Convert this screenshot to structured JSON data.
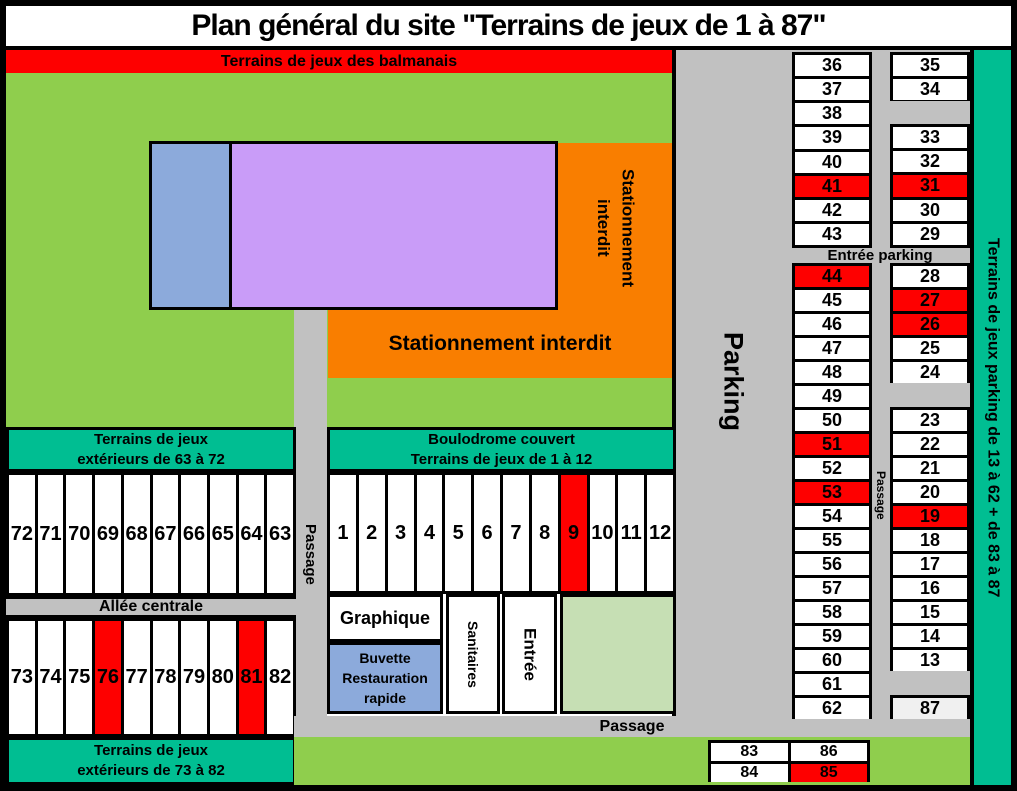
{
  "title": "Plan général du site \"Terrains de jeux de 1 à 87\"",
  "banners": {
    "balmanais": "Terrains de jeux des balmanais",
    "ext6372": [
      "Terrains de jeux",
      "extérieurs de 63 à 72"
    ],
    "boulodrome": [
      "Boulodrome couvert",
      "Terrains de jeux de 1 à 12"
    ],
    "ext7382": [
      "Terrains de jeux",
      "extérieurs de 73 à 82"
    ],
    "teal_right": "Terrains de jeux parking de 13 à 62 + de 83 à 87"
  },
  "labels": {
    "stationnement_vertical": [
      "Stationnement",
      "interdit"
    ],
    "stationnement_horizontal": "Stationnement interdit",
    "parking": "Parking",
    "passage_left": "Passage",
    "passage_right": "Passage",
    "passage_bottom": "Passage",
    "allee_centrale": "Allée centrale",
    "entree_parking": "Entrée parking",
    "graphique": "Graphique",
    "buvette": [
      "Buvette",
      "Restauration",
      "rapide"
    ],
    "sanitaires": "Sanitaires",
    "entree": "Entrée"
  },
  "colors": {
    "green": "#8FCE4D",
    "pale_green": "#C6DFB4",
    "teal": "#00BE92",
    "orange": "#F97E00",
    "red": "#FE0000",
    "gray": "#C1C1C1",
    "blue": "#8CAADB",
    "purple": "#C99CF8",
    "light_cell": "#F0F0F0"
  },
  "courts": {
    "row_63_72": [
      {
        "n": "72"
      },
      {
        "n": "71"
      },
      {
        "n": "70"
      },
      {
        "n": "69"
      },
      {
        "n": "68"
      },
      {
        "n": "67"
      },
      {
        "n": "66"
      },
      {
        "n": "65"
      },
      {
        "n": "64"
      },
      {
        "n": "63"
      }
    ],
    "row_1_12": [
      {
        "n": "1"
      },
      {
        "n": "2"
      },
      {
        "n": "3"
      },
      {
        "n": "4"
      },
      {
        "n": "5"
      },
      {
        "n": "6"
      },
      {
        "n": "7"
      },
      {
        "n": "8"
      },
      {
        "n": "9",
        "bg": "red"
      },
      {
        "n": "10"
      },
      {
        "n": "11"
      },
      {
        "n": "12"
      }
    ],
    "row_73_82": [
      {
        "n": "73"
      },
      {
        "n": "74"
      },
      {
        "n": "75"
      },
      {
        "n": "76",
        "bg": "red"
      },
      {
        "n": "77"
      },
      {
        "n": "78"
      },
      {
        "n": "79"
      },
      {
        "n": "80"
      },
      {
        "n": "81",
        "bg": "red"
      },
      {
        "n": "82"
      }
    ],
    "colA_top": [
      {
        "n": "36"
      },
      {
        "n": "37"
      },
      {
        "n": "38"
      },
      {
        "n": "39"
      },
      {
        "n": "40"
      },
      {
        "n": "41",
        "bg": "red"
      },
      {
        "n": "42"
      },
      {
        "n": "43"
      }
    ],
    "colB_top_a": [
      {
        "n": "35"
      },
      {
        "n": "34"
      }
    ],
    "colB_top_b": [
      {
        "n": "33"
      },
      {
        "n": "32"
      },
      {
        "n": "31",
        "bg": "red"
      },
      {
        "n": "30"
      },
      {
        "n": "29"
      }
    ],
    "colA_bottom": [
      {
        "n": "44",
        "bg": "red"
      },
      {
        "n": "45"
      },
      {
        "n": "46"
      },
      {
        "n": "47"
      },
      {
        "n": "48"
      },
      {
        "n": "49"
      },
      {
        "n": "50"
      },
      {
        "n": "51",
        "bg": "red"
      },
      {
        "n": "52"
      },
      {
        "n": "53",
        "bg": "red"
      },
      {
        "n": "54"
      },
      {
        "n": "55"
      },
      {
        "n": "56"
      },
      {
        "n": "57"
      },
      {
        "n": "58"
      },
      {
        "n": "59"
      },
      {
        "n": "60"
      },
      {
        "n": "61"
      },
      {
        "n": "62"
      }
    ],
    "colB_bottom_a": [
      {
        "n": "28"
      },
      {
        "n": "27",
        "bg": "red"
      },
      {
        "n": "26",
        "bg": "red"
      },
      {
        "n": "25"
      },
      {
        "n": "24"
      }
    ],
    "colB_bottom_b": [
      {
        "n": "23"
      },
      {
        "n": "22"
      },
      {
        "n": "21"
      },
      {
        "n": "20"
      },
      {
        "n": "19",
        "bg": "red"
      },
      {
        "n": "18"
      },
      {
        "n": "17"
      },
      {
        "n": "16"
      },
      {
        "n": "15"
      },
      {
        "n": "14"
      },
      {
        "n": "13"
      }
    ],
    "colB_87": [
      {
        "n": "87",
        "bg": "light"
      }
    ],
    "bottom_block": [
      {
        "n": "83"
      },
      {
        "n": "86"
      },
      {
        "n": "84"
      },
      {
        "n": "85",
        "bg": "red"
      }
    ]
  }
}
